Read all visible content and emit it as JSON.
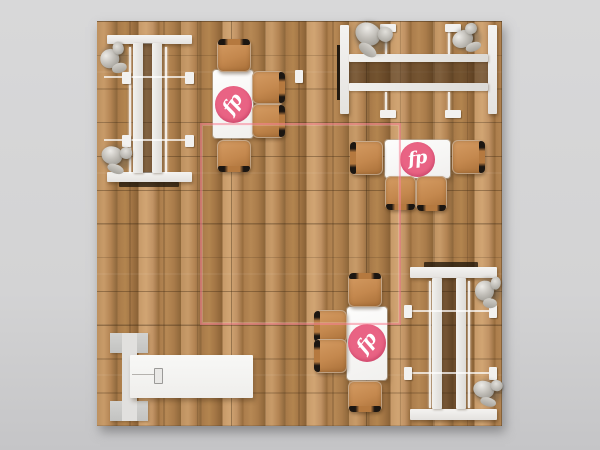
{
  "scene": {
    "name": "exhibit-booth-floor-plan-render",
    "canvas": {
      "width": 600,
      "height": 450
    },
    "background_color_top": "#d8d8d9",
    "background_color_bottom": "#c5c5c7",
    "floor": {
      "x": 97,
      "y": 21,
      "width": 405,
      "height": 405,
      "wood_light": "#c89b69",
      "wood_mid": "#b28253",
      "wood_dark": "#8d6639",
      "grid_color": "rgba(62,41,18,0.38)",
      "grid_size_px": 33.75
    },
    "boundary": {
      "x": 200,
      "y": 123,
      "width": 197,
      "height": 198,
      "color": "rgba(248,130,150,0.55)"
    }
  },
  "logo": {
    "text": "fp",
    "circle_color": "#e96384",
    "text_color": "#ffffff"
  },
  "structures": [
    {
      "kind": "panel",
      "x": 107,
      "y": 35,
      "w": 85,
      "h": 9
    },
    {
      "kind": "panel",
      "x": 107,
      "y": 172,
      "w": 85,
      "h": 10
    },
    {
      "kind": "darkstrip",
      "x": 119,
      "y": 182,
      "w": 60,
      "h": 5
    },
    {
      "kind": "shade",
      "x": 143,
      "y": 43,
      "w": 10,
      "h": 130
    },
    {
      "kind": "rail",
      "x": 133,
      "y": 43,
      "w": 10,
      "h": 130
    },
    {
      "kind": "rail",
      "x": 152,
      "y": 43,
      "w": 10,
      "h": 130
    },
    {
      "kind": "tube",
      "x": 129,
      "y": 47,
      "w": 2,
      "h": 126
    },
    {
      "kind": "tube",
      "x": 165,
      "y": 47,
      "w": 2,
      "h": 126
    },
    {
      "kind": "crossline",
      "x": 104,
      "y": 76,
      "w": 89,
      "h": 2
    },
    {
      "kind": "crossline",
      "x": 104,
      "y": 139,
      "w": 89,
      "h": 2
    },
    {
      "kind": "tab",
      "x": 122,
      "y": 72,
      "w": 9,
      "h": 12
    },
    {
      "kind": "tab",
      "x": 185,
      "y": 72,
      "w": 9,
      "h": 12
    },
    {
      "kind": "tab",
      "x": 122,
      "y": 135,
      "w": 9,
      "h": 12
    },
    {
      "kind": "tab",
      "x": 185,
      "y": 135,
      "w": 9,
      "h": 12
    },
    {
      "kind": "tab",
      "x": 295,
      "y": 70,
      "w": 8,
      "h": 13
    },
    {
      "kind": "blackstrip",
      "x": 337,
      "y": 45,
      "w": 3,
      "h": 55
    },
    {
      "kind": "panel",
      "x": 340,
      "y": 25,
      "w": 9,
      "h": 89
    },
    {
      "kind": "panel",
      "x": 488,
      "y": 25,
      "w": 9,
      "h": 89
    },
    {
      "kind": "shade",
      "x": 349,
      "y": 62,
      "w": 139,
      "h": 21
    },
    {
      "kind": "rail",
      "x": 349,
      "y": 54,
      "w": 139,
      "h": 8
    },
    {
      "kind": "rail",
      "x": 349,
      "y": 83,
      "w": 139,
      "h": 8
    },
    {
      "kind": "tube",
      "x": 385,
      "y": 27,
      "w": 2,
      "h": 27
    },
    {
      "kind": "tube",
      "x": 448,
      "y": 27,
      "w": 2,
      "h": 27
    },
    {
      "kind": "tube",
      "x": 385,
      "y": 92,
      "w": 2,
      "h": 20
    },
    {
      "kind": "tube",
      "x": 448,
      "y": 92,
      "w": 2,
      "h": 20
    },
    {
      "kind": "tab",
      "x": 380,
      "y": 24,
      "w": 16,
      "h": 8
    },
    {
      "kind": "tab",
      "x": 445,
      "y": 24,
      "w": 16,
      "h": 8
    },
    {
      "kind": "tab",
      "x": 380,
      "y": 110,
      "w": 16,
      "h": 8
    },
    {
      "kind": "tab",
      "x": 445,
      "y": 110,
      "w": 16,
      "h": 8
    },
    {
      "kind": "darkstrip",
      "x": 424,
      "y": 262,
      "w": 54,
      "h": 6
    },
    {
      "kind": "panel",
      "x": 410,
      "y": 267,
      "w": 87,
      "h": 11
    },
    {
      "kind": "panel",
      "x": 410,
      "y": 409,
      "w": 87,
      "h": 11
    },
    {
      "kind": "shade",
      "x": 442,
      "y": 278,
      "w": 14,
      "h": 131
    },
    {
      "kind": "rail",
      "x": 432,
      "y": 278,
      "w": 10,
      "h": 131
    },
    {
      "kind": "rail",
      "x": 456,
      "y": 278,
      "w": 10,
      "h": 131
    },
    {
      "kind": "tube",
      "x": 429,
      "y": 281,
      "w": 2,
      "h": 127
    },
    {
      "kind": "tube",
      "x": 468,
      "y": 281,
      "w": 2,
      "h": 127
    },
    {
      "kind": "crossline",
      "x": 406,
      "y": 310,
      "w": 89,
      "h": 2
    },
    {
      "kind": "crossline",
      "x": 406,
      "y": 372,
      "w": 89,
      "h": 2
    },
    {
      "kind": "tab",
      "x": 404,
      "y": 305,
      "w": 8,
      "h": 13
    },
    {
      "kind": "tab",
      "x": 489,
      "y": 305,
      "w": 8,
      "h": 13
    },
    {
      "kind": "tab",
      "x": 404,
      "y": 367,
      "w": 8,
      "h": 13
    },
    {
      "kind": "tab",
      "x": 489,
      "y": 367,
      "w": 8,
      "h": 13
    },
    {
      "kind": "cap",
      "x": 110,
      "y": 333,
      "w": 38,
      "h": 20
    },
    {
      "kind": "cap",
      "x": 110,
      "y": 401,
      "w": 38,
      "h": 20
    },
    {
      "kind": "strip",
      "x": 122,
      "y": 333,
      "w": 15,
      "h": 88
    },
    {
      "kind": "slab",
      "x": 130,
      "y": 355,
      "w": 123,
      "h": 43
    },
    {
      "kind": "hairline",
      "x": 132,
      "y": 374,
      "w": 24,
      "h": 1
    },
    {
      "kind": "item",
      "x": 154,
      "y": 368,
      "w": 9,
      "h": 16
    }
  ],
  "dining_sets": [
    {
      "id": "northwest",
      "table": {
        "x": 213,
        "y": 70,
        "w": 40,
        "h": 68
      },
      "logo": {
        "cx": 233,
        "cy": 104,
        "d": 37,
        "rot": -55
      },
      "chairs": [
        {
          "x": 217,
          "y": 39,
          "w": 34,
          "h": 33,
          "back": "top"
        },
        {
          "x": 252,
          "y": 71,
          "w": 33,
          "h": 33,
          "back": "right"
        },
        {
          "x": 252,
          "y": 104,
          "w": 33,
          "h": 34,
          "back": "right"
        },
        {
          "x": 217,
          "y": 140,
          "w": 34,
          "h": 32,
          "back": "bottom"
        }
      ]
    },
    {
      "id": "east",
      "table": {
        "x": 385,
        "y": 140,
        "w": 65,
        "h": 38
      },
      "logo": {
        "cx": 417,
        "cy": 159,
        "d": 35,
        "rot": -8
      },
      "chairs": [
        {
          "x": 350,
          "y": 141,
          "w": 33,
          "h": 34,
          "back": "left"
        },
        {
          "x": 452,
          "y": 140,
          "w": 33,
          "h": 34,
          "back": "right"
        },
        {
          "x": 385,
          "y": 176,
          "w": 31,
          "h": 34,
          "back": "bottom"
        },
        {
          "x": 416,
          "y": 176,
          "w": 31,
          "h": 35,
          "back": "bottom"
        }
      ]
    },
    {
      "id": "south",
      "table": {
        "x": 347,
        "y": 307,
        "w": 40,
        "h": 73
      },
      "logo": {
        "cx": 367,
        "cy": 343,
        "d": 38,
        "rot": -52
      },
      "chairs": [
        {
          "x": 348,
          "y": 273,
          "w": 34,
          "h": 34,
          "back": "top"
        },
        {
          "x": 314,
          "y": 310,
          "w": 33,
          "h": 33,
          "back": "left"
        },
        {
          "x": 314,
          "y": 339,
          "w": 33,
          "h": 34,
          "back": "left"
        },
        {
          "x": 348,
          "y": 381,
          "w": 34,
          "h": 31,
          "back": "bottom"
        }
      ]
    }
  ],
  "figures": [
    {
      "x": 99,
      "y": 41,
      "w": 30,
      "h": 33,
      "rot": -15
    },
    {
      "x": 100,
      "y": 142,
      "w": 33,
      "h": 31,
      "rot": 20
    },
    {
      "x": 352,
      "y": 18,
      "w": 41,
      "h": 38,
      "rot": 35
    },
    {
      "x": 451,
      "y": 23,
      "w": 32,
      "h": 30,
      "rot": -20
    },
    {
      "x": 474,
      "y": 274,
      "w": 29,
      "h": 34,
      "rot": 5
    },
    {
      "x": 472,
      "y": 376,
      "w": 32,
      "h": 30,
      "rot": 15
    }
  ]
}
